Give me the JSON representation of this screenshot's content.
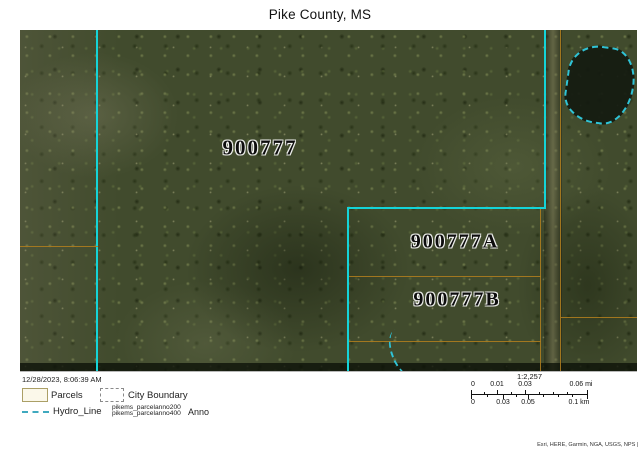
{
  "title": "Pike County, MS",
  "map": {
    "parcel_labels": [
      {
        "text": "900777"
      },
      {
        "text": "900777A"
      },
      {
        "text": "900777B"
      }
    ],
    "layers": {
      "parcel_boundary_color": "#14d4d8",
      "parcel_line_color": "#ad7c1e",
      "hydro_line_color": "#2fc3d6"
    }
  },
  "footer": {
    "timestamp": "12/28/2023, 8:06:39 AM",
    "legend": {
      "parcels_label": "Parcels",
      "city_boundary_label": "City Boundary",
      "hydro_line_label": "Hydro_Line",
      "anno_sublabels": [
        "pikems_parcelanno200",
        "pikems_parcelanno400"
      ],
      "anno_label": "Anno"
    },
    "scale": {
      "ratio": "1:2,257",
      "miles_ticks": [
        "0",
        "0.01",
        "0.03",
        "0.06 mi"
      ],
      "km_ticks": [
        "0",
        "0.03",
        "0.05",
        "0.1 km"
      ]
    },
    "attribution": "Esri, HERE, Garmin, NGA, USGS, NPS |"
  }
}
